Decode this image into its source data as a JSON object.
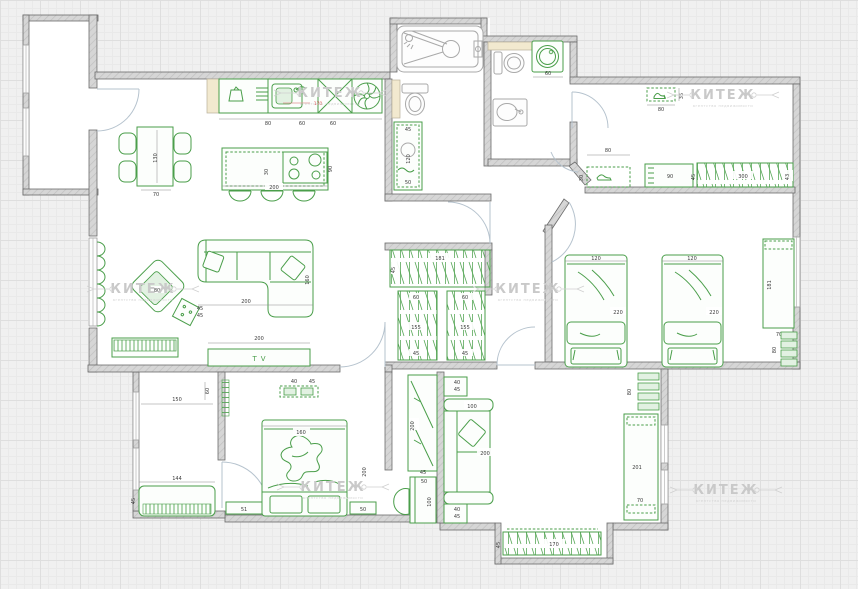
{
  "watermark": {
    "title": "КИТЕЖ",
    "subtitle": "агентство недвижимости"
  },
  "labels": {
    "tv": "TV"
  },
  "colors": {
    "furniture_green": "#4a9e4a",
    "wall_fill": "#d6d6d6",
    "wall_edge": "#6b6b6b",
    "counter_beige": "#f2e9cf",
    "dim_text": "#3c3c3c",
    "dim_red": "#d95555",
    "watermark_gray": "#c9c9c9",
    "door_arc": "#b6c3ce",
    "fixture_gray": "#a9a9a9",
    "grid_bg": "#f0f0f0"
  },
  "dims": {
    "dining_l": "130",
    "dining_w": "70",
    "counter_80": "80",
    "counter_60a": "60",
    "counter_60b": "60",
    "counter_170": "170",
    "island_200": "200",
    "island_30": "30",
    "island_90": "90",
    "armchair_80": "80",
    "sidetable_45a": "45",
    "sidetable_45b": "45",
    "sofa_200": "200",
    "sofa_160": "160",
    "tv_200": "200",
    "bathcab_45": "45",
    "bathcab_120": "120",
    "bathcab_50": "50",
    "washer_60": "60",
    "shoeshelf_35": "35",
    "shoeshelf_80": "80",
    "hallbench_80": "80",
    "hallbench_30": "30",
    "hallcab_90": "90",
    "hallward_45": "45",
    "hallward_300": "300",
    "hallward_43": "43",
    "closet_181": "181",
    "closet_45": "45",
    "closetL_60": "60",
    "closetL_155": "155",
    "closetL_45": "45",
    "closetR_60": "60",
    "closetR_155": "155",
    "closetR_45": "45",
    "bed1_120": "120",
    "bed1_220": "220",
    "bed2_120": "120",
    "bed2_220": "220",
    "desk_181": "181",
    "desk_70": "70",
    "shelf2_80": "80",
    "mshelf_40": "40",
    "mshelf_45": "45",
    "mbed_160": "160",
    "mbed_200": "200",
    "nstand_51": "51",
    "nstand_50": "50",
    "balc_150": "150",
    "balc_60": "60",
    "balcbench_144": "144",
    "balcbench_45": "45",
    "nookward_200": "200",
    "nookward_45": "45",
    "nookdesk_50": "50",
    "nookdesk_100": "100",
    "table1_40": "40",
    "table1_45": "45",
    "table2_40": "40",
    "table2_45": "45",
    "brsofa_100": "100",
    "brsofa_200": "200",
    "brcab_201": "201",
    "brcab_70": "70",
    "brshelf_80": "80",
    "bumpward_170": "170",
    "bumpward_45": "45"
  }
}
